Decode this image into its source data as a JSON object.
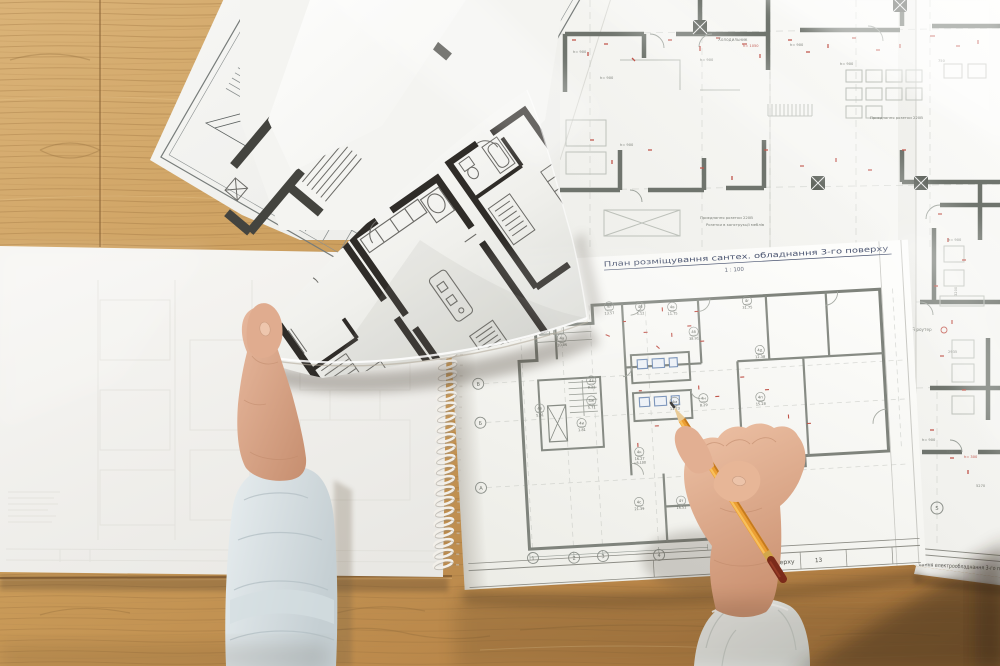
{
  "notebook_page": {
    "title": "План розміщування сантех. обладнання 3-го поверху",
    "scale_label": "1 : 100",
    "page_number": "13",
    "titleblock_fragment": "го поверху",
    "grid_rows": [
      "В",
      "Б",
      "А"
    ],
    "grid_cols": [
      "1",
      "2",
      "3",
      "4"
    ],
    "elevation_mark": "+8.100",
    "room_tags": [
      {
        "code": "4л",
        "area": "13.57"
      },
      {
        "code": "4б",
        "area": "5.12"
      },
      {
        "code": "4в",
        "area": "11.75"
      },
      {
        "code": "4г",
        "area": "31.75"
      },
      {
        "code": "4а",
        "area": "10.86"
      },
      {
        "code": "4б",
        "area": "38.91"
      },
      {
        "code": "4д",
        "area": "12.38"
      },
      {
        "code": "4е",
        "area": "5.31"
      },
      {
        "code": "4ж",
        "area": "5.71"
      },
      {
        "code": "4з",
        "area": "8.21"
      },
      {
        "code": "4и",
        "area": "1.81"
      },
      {
        "code": "4м",
        "area": "11.23"
      },
      {
        "code": "4н",
        "area": "8.29"
      },
      {
        "code": "4п",
        "area": "15.28"
      },
      {
        "code": "4к",
        "area": "16.27"
      },
      {
        "code": "4с",
        "area": "21.39"
      },
      {
        "code": "4т",
        "area": "16.51"
      }
    ]
  },
  "large_blueprint": {
    "titleblock_fragment": "вання електрообладнання 3-го по",
    "grid_bubble_label": "5",
    "annotations": {
      "fridge": "Холодильник",
      "wifi": "Wi-Fi роутер",
      "socket_note": "Приєднання розетки 220В",
      "socket_note2": "Розетки в конструкції меблів",
      "h900": "h= 900",
      "h300": "h= 300",
      "h1050": "h= 1050",
      "dim2935": "2935",
      "dim3200": "3200",
      "dim750": "750",
      "dim5270": "5270"
    }
  },
  "colors": {
    "wood": "#c59758",
    "paper": "#f4f4f1",
    "blueprint_wall": "#6f746d",
    "dark_wall": "#2f2c28",
    "red_mark": "#c0544a",
    "pencil_orange": "#ec9f33",
    "pencil_end": "#7b2b1a",
    "sleeve_left": "#dfe6e8",
    "sleeve_right": "#eef0ee",
    "skin": "#d9a486"
  }
}
